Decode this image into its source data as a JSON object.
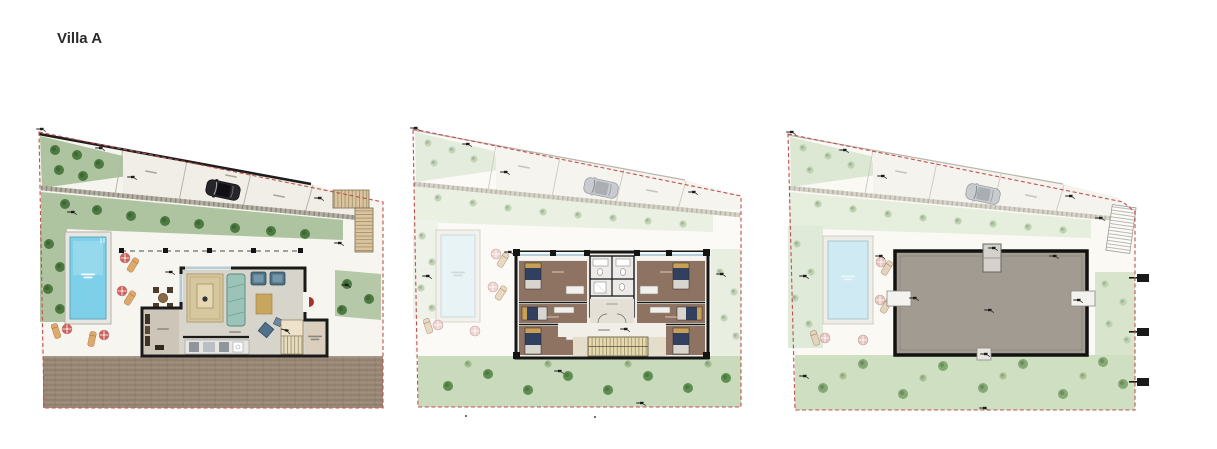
{
  "page": {
    "title": "Villa A",
    "background": "#ffffff"
  },
  "plans": [
    {
      "id": "plan-1",
      "position": "left"
    },
    {
      "id": "plan-2",
      "position": "center"
    },
    {
      "id": "plan-3",
      "position": "right"
    }
  ],
  "palette": {
    "boundary_red": "#c0504d",
    "garden_green": "#aec4a1",
    "garden_green_faded": "#e4ecdd",
    "tree_green": "#4c7a40",
    "pool_blue": "#7ed0e9",
    "pool_blue_faded": "#cfeaf3",
    "umbrella_red": "#d0625e",
    "lounger_tan": "#dfa96b",
    "wall_black": "#1a1a1a",
    "soil_brown": "#9b8a79",
    "roof_gray": "#a29b91",
    "bedroom_floor": "#8e7262",
    "bed_navy": "#31405f",
    "pillow_tan": "#c9a156",
    "stair_tan": "#e6d9ae",
    "car_dark": "#26262a",
    "car_light": "#c8ccd0",
    "driveway": "#f0eee7"
  }
}
